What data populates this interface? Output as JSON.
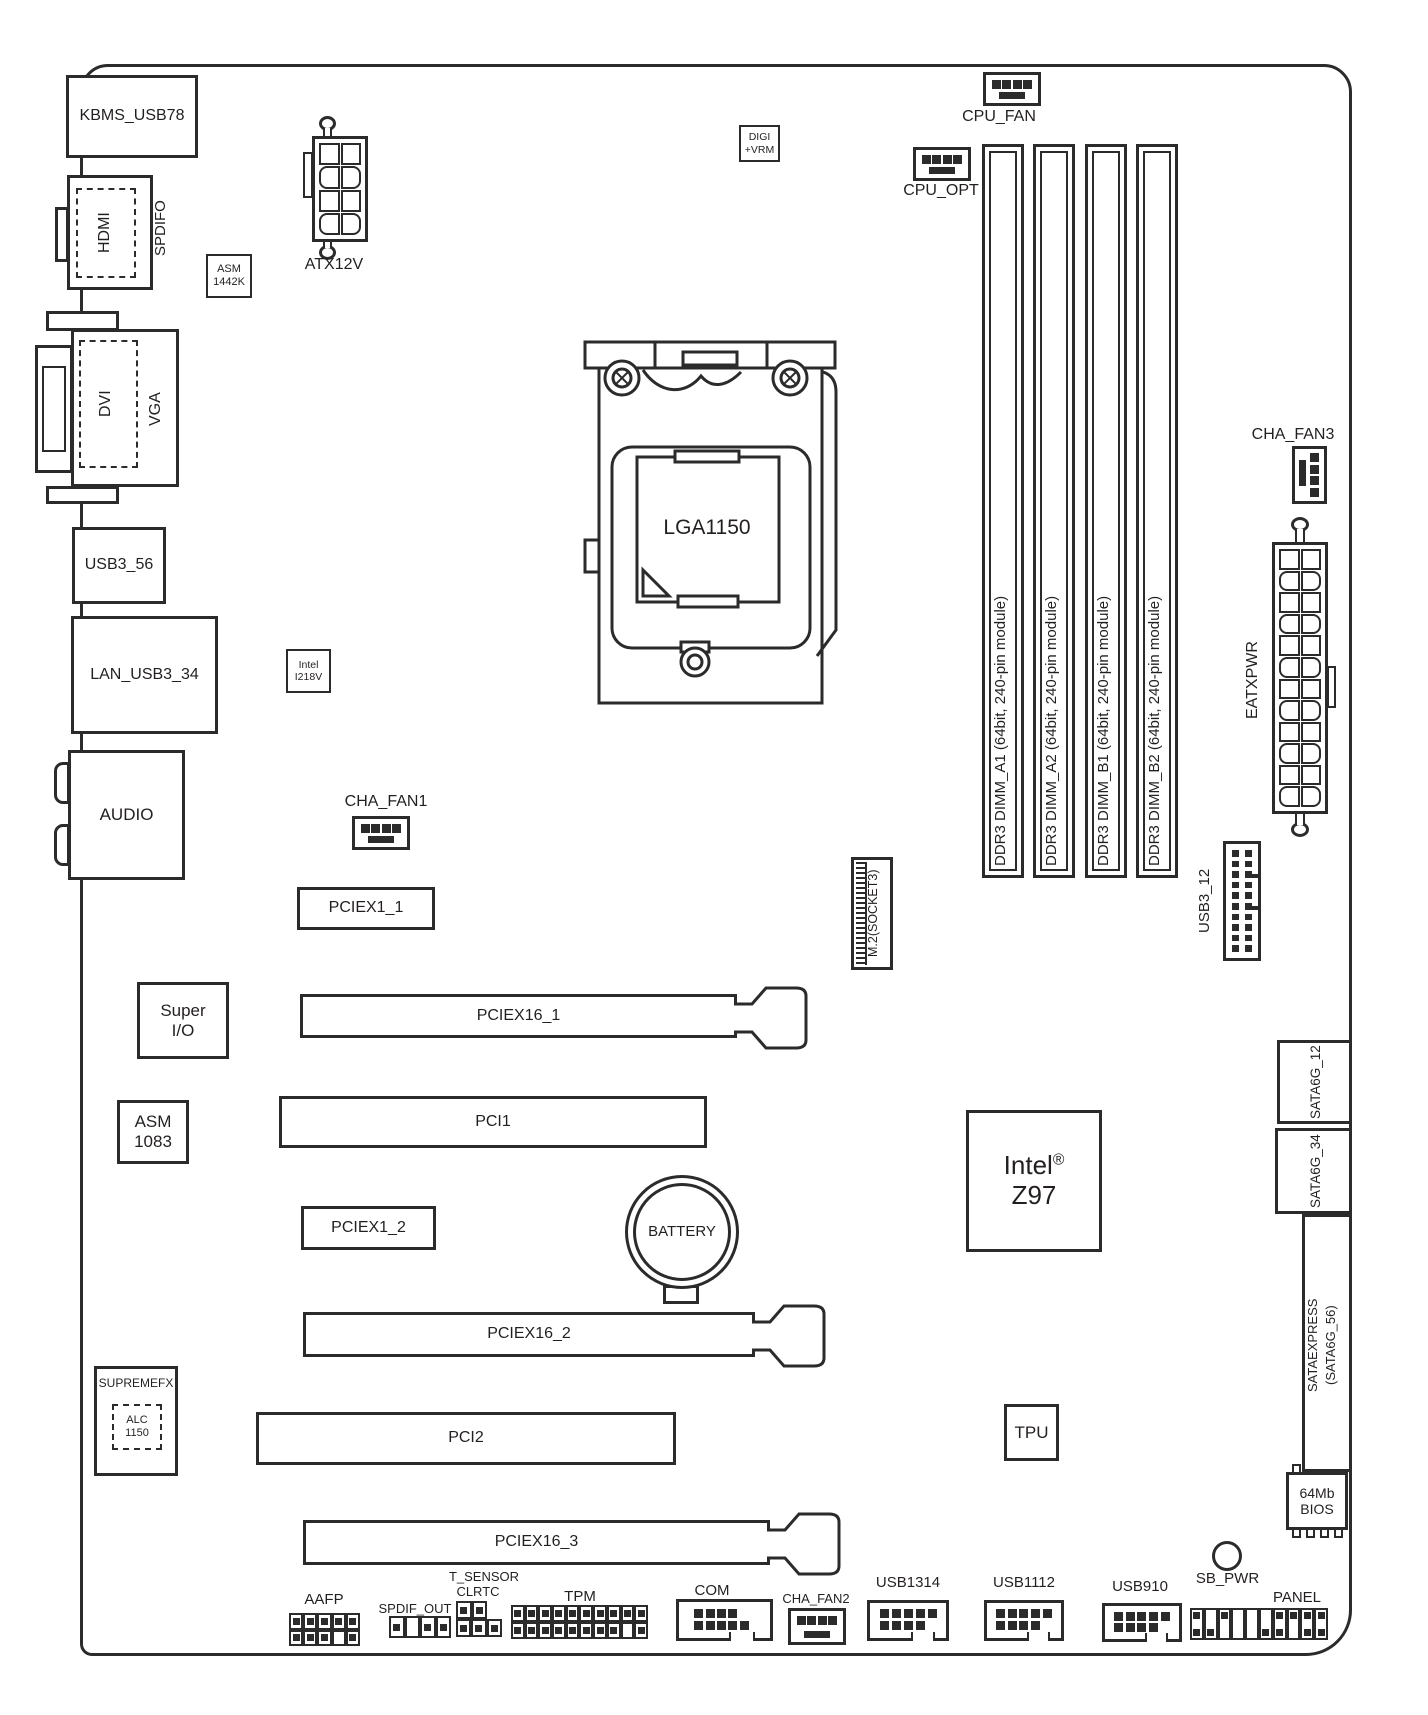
{
  "io": {
    "kbms": "KBMS_USB78",
    "hdmi": "HDMI",
    "spdifo": "SPDIFO",
    "dvi": "DVI",
    "vga": "VGA",
    "usb3_56": "USB3_56",
    "lan": "LAN_USB3_34",
    "audio": "AUDIO"
  },
  "chips": {
    "asm1442k_1": "ASM",
    "asm1442k_2": "1442K",
    "digivrm_1": "DIGI",
    "digivrm_2": "+VRM",
    "i218v_1": "Intel",
    "i218v_2": "I218V",
    "superio_1": "Super",
    "superio_2": "I/O",
    "asm1083_1": "ASM",
    "asm1083_2": "1083",
    "supremefx": "SUPREMEFX",
    "alc_1": "ALC",
    "alc_2": "1150",
    "pch_brand": "Intel",
    "pch_reg": "®",
    "pch_model": "Z97",
    "tpu": "TPU",
    "bios_1": "64Mb",
    "bios_2": "BIOS"
  },
  "cpu": {
    "socket": "LGA1150"
  },
  "memory": {
    "dimms": [
      "DDR3 DIMM_A1 (64bit, 240-pin module)",
      "DDR3 DIMM_A2 (64bit, 240-pin module)",
      "DDR3 DIMM_B1 (64bit, 240-pin module)",
      "DDR3 DIMM_B2 (64bit, 240-pin module)"
    ]
  },
  "power": {
    "atx12v": "ATX12V",
    "eatxpwr": "EATXPWR"
  },
  "fans": {
    "cpu_fan": "CPU_FAN",
    "cpu_opt": "CPU_OPT",
    "cha_fan1": "CHA_FAN1",
    "cha_fan2": "CHA_FAN2",
    "cha_fan3": "CHA_FAN3"
  },
  "slots": {
    "pciex1_1": "PCIEX1_1",
    "pciex16_1": "PCIEX16_1",
    "pci1": "PCI1",
    "pciex1_2": "PCIEX1_2",
    "pciex16_2": "PCIEX16_2",
    "pci2": "PCI2",
    "pciex16_3": "PCIEX16_3",
    "m2": "M.2(SOCKET3)"
  },
  "storage": {
    "sata6g_12": "SATA6G_12",
    "sata6g_34": "SATA6G_34",
    "sataexpress_1": "SATAEXPRESS",
    "sataexpress_2": "(SATA6G_56)"
  },
  "headers": {
    "usb3_12": "USB3_12",
    "aafp": "AAFP",
    "spdif_out": "SPDIF_OUT",
    "t_sensor": "T_SENSOR",
    "clrtc": "CLRTC",
    "tpm": "TPM",
    "com": "COM",
    "usb1314": "USB1314",
    "usb1112": "USB1112",
    "usb910": "USB910",
    "panel": "PANEL",
    "sb_pwr": "SB_PWR"
  },
  "misc": {
    "battery": "BATTERY"
  },
  "colors": {
    "line": "#2b2b2b",
    "text": "#231f20",
    "bg": "#ffffff"
  }
}
